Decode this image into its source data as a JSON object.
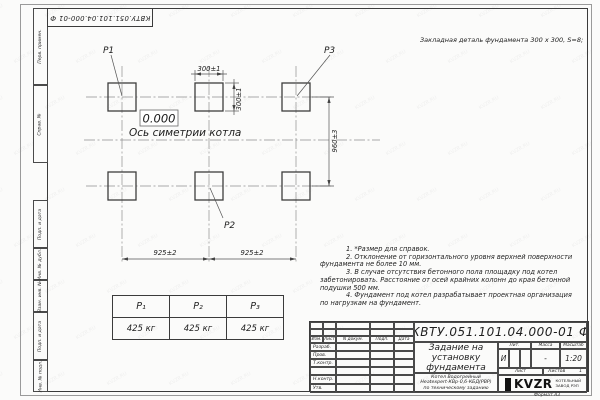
{
  "page": {
    "doc_number_flipped": "КВТУ.051.101.04.000-01 Ф",
    "format_label": "Формат А3",
    "watermark": "KVZR.RU"
  },
  "margin_strip": {
    "labels": [
      "Перв. примен.",
      "Справ. №",
      "Подп. и дата",
      "Инв. № дубл.",
      "Взам. инв. №",
      "Подп. и дата",
      "Инв. № подл."
    ]
  },
  "annotations": {
    "embedded_detail": "Закладная деталь фундамента  300 x 300,  S=8;",
    "elevation": "0.000",
    "symmetry_axis": "Ось симетрии котла"
  },
  "drawing": {
    "labels": {
      "p1": "Р1",
      "p2": "Р2",
      "p3": "Р3"
    },
    "dimensions": {
      "pad_width": "300±1",
      "pad_height": "300±1",
      "row_spacing": "960±3",
      "col_spacing_left": "925±2",
      "col_spacing_right": "925±2"
    }
  },
  "notes": {
    "lines": [
      "1. *Размер для справок.",
      "2. Отклонение от горизонтального уровня верхней поверхности",
      "фундамента не более 10 мм.",
      "3. В случае отсутствия бетонного пола площадку под котел",
      "забетонировать. Расстояние от осей крайних колонн до края бетонной",
      "подушки 500 мм.",
      "4. Фундамент под котел разрабатывает проектная организация",
      "по нагрузкам на фундамент."
    ]
  },
  "load_table": {
    "headers": [
      "Р₁",
      "Р₂",
      "Р₃"
    ],
    "values": [
      "425 кг",
      "425 кг",
      "425 кг"
    ]
  },
  "title_block": {
    "designation": "КВТУ.051.101.04.000-01  Ф",
    "title_lines": [
      "Задание на",
      "установку",
      "фундамента"
    ],
    "subtitle_lines": [
      "Котел Водогрейный",
      "Heatexpert-КВр-0,6-КБД(РВР)",
      "по техническому заданию"
    ],
    "rev_headers": [
      "Изм.",
      "Лист",
      "N докум.",
      "Подп.",
      "Дата"
    ],
    "roles": [
      "Разраб.",
      "Пров.",
      "Т.контр.",
      "",
      "Н.контр.",
      "Утв."
    ],
    "lit_label": "Лит.",
    "mass_label": "Масса",
    "scale_label": "Масштаб",
    "lit_value": "И",
    "mass_value": "-",
    "scale_value": "1:20",
    "sheet_label": "Лист",
    "sheets_label": "Листов",
    "sheets_value": "1",
    "logo_text": "KVZR",
    "logo_caption_lines": [
      "КОТЕЛЬНЫЙ",
      "ЗАВОД РЭП"
    ]
  }
}
